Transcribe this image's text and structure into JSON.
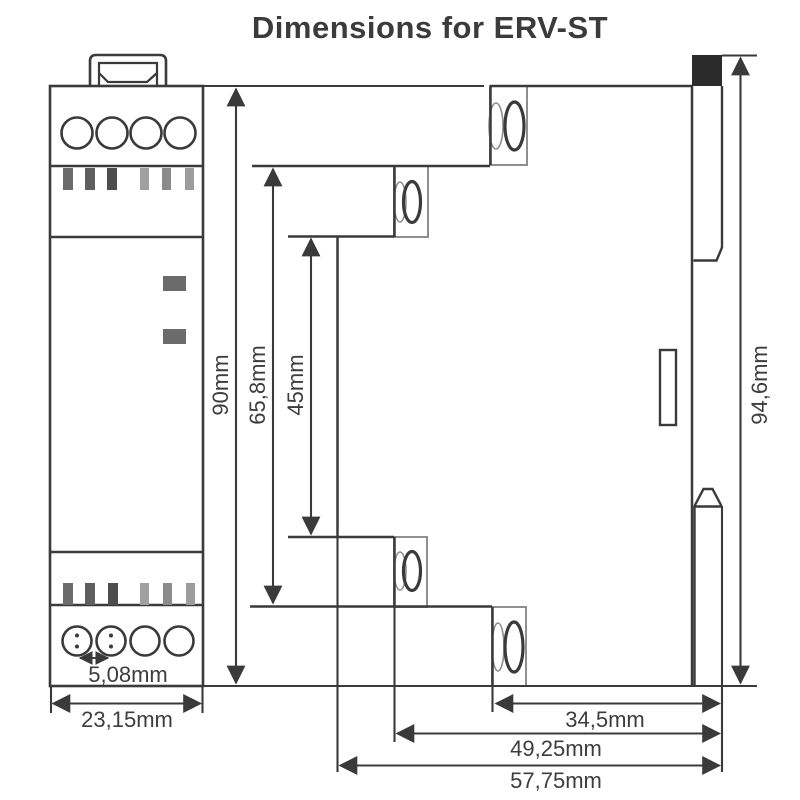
{
  "title": "Dimensions for ERV-ST",
  "dims": {
    "width": "23,15mm",
    "pitch": "5,08mm",
    "height": "90mm",
    "height_terminals": "65,8mm",
    "height_body": "45mm",
    "height_total": "94,6mm",
    "depth_rear": "34,5mm",
    "depth_mid": "49,25mm",
    "depth_total": "57,75mm"
  },
  "front": {
    "bar_colors": [
      "#6b6b6b",
      "#5f5f5f",
      "#4d4d4d",
      "#a0a0a0",
      "#8b8b8b",
      "#9c9c9c"
    ],
    "led_color": "#6b6b6b"
  },
  "colors": {
    "line": "#3a3a3a",
    "block_outline": "#8f8f8f",
    "clip_fill": "#2b2b2b",
    "text": "#3d3d3d",
    "background": "#ffffff"
  }
}
